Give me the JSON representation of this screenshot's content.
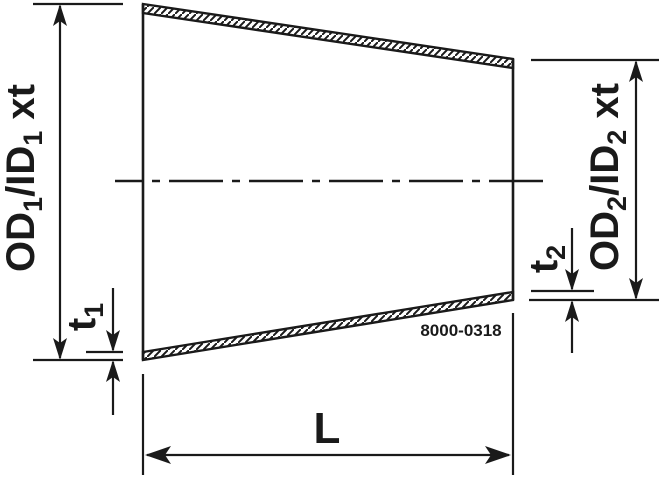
{
  "drawing": {
    "type": "concentric-reducer technical drawing",
    "drawing_number": "8000-0318",
    "dimension_labels": {
      "od1": {
        "p1": "OD",
        "s1": "1",
        "p2": "/ID",
        "s2": "1",
        "p3": " xt",
        "full": "OD1/ID1 xt"
      },
      "od2": {
        "p1": "OD",
        "s1": "2",
        "p2": "/ID",
        "s2": "2",
        "p3": " xt",
        "full": "OD2/ID2 xt"
      },
      "t1": {
        "p": "t",
        "s": "1",
        "full": "t1"
      },
      "t2": {
        "p": "t",
        "s": "2",
        "full": "t2"
      },
      "length": "L"
    }
  },
  "colors": {
    "ink": "#1a1a1a",
    "background": "#ffffff"
  }
}
